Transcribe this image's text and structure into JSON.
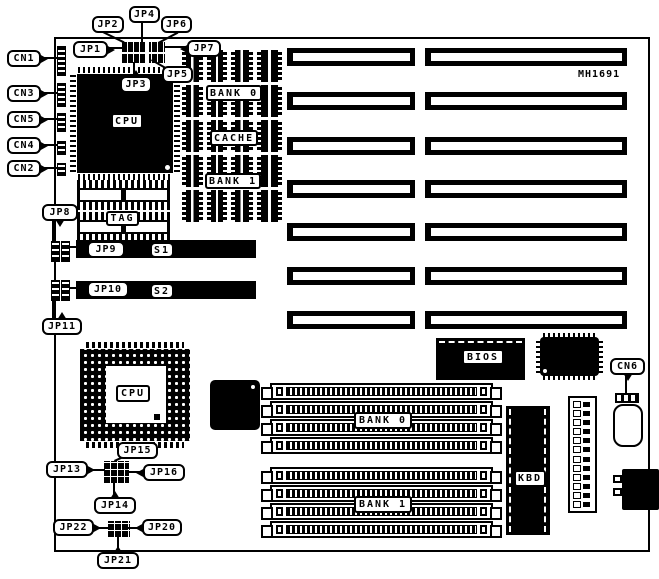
{
  "model_number": "MH1691",
  "connectors": {
    "cn1": "CN1",
    "cn2": "CN2",
    "cn3": "CN3",
    "cn4": "CN4",
    "cn5": "CN5",
    "cn6": "CN6"
  },
  "jumpers": {
    "jp1": "JP1",
    "jp2": "JP2",
    "jp3": "JP3",
    "jp4": "JP4",
    "jp5": "JP5",
    "jp6": "JP6",
    "jp7": "JP7",
    "jp8": "JP8",
    "jp9": "JP9",
    "jp10": "JP10",
    "jp11": "JP11",
    "jp13": "JP13",
    "jp14": "JP14",
    "jp15": "JP15",
    "jp16": "JP16",
    "jp20": "JP20",
    "jp21": "JP21",
    "jp22": "JP22"
  },
  "slots": {
    "s1": "S1",
    "s2": "S2"
  },
  "chips": {
    "cpu_qfp": "CPU",
    "cpu_socket": "CPU",
    "bios": "BIOS",
    "kbd": "KBD",
    "tag": "TAG",
    "cache": "CACHE"
  },
  "memory": {
    "cache_bank0": "BANK 0",
    "cache_bank1": "BANK 1",
    "simm_bank0": "BANK 0",
    "simm_bank1": "BANK 1"
  },
  "counts": {
    "isa_slot_rows": 7,
    "simm_slots_per_bank": 4,
    "cache_columns": 4,
    "cache_chips_per_column": 5,
    "power_pin_rows": 12
  },
  "colors": {
    "ink": "#000000",
    "paper": "#ffffff"
  }
}
